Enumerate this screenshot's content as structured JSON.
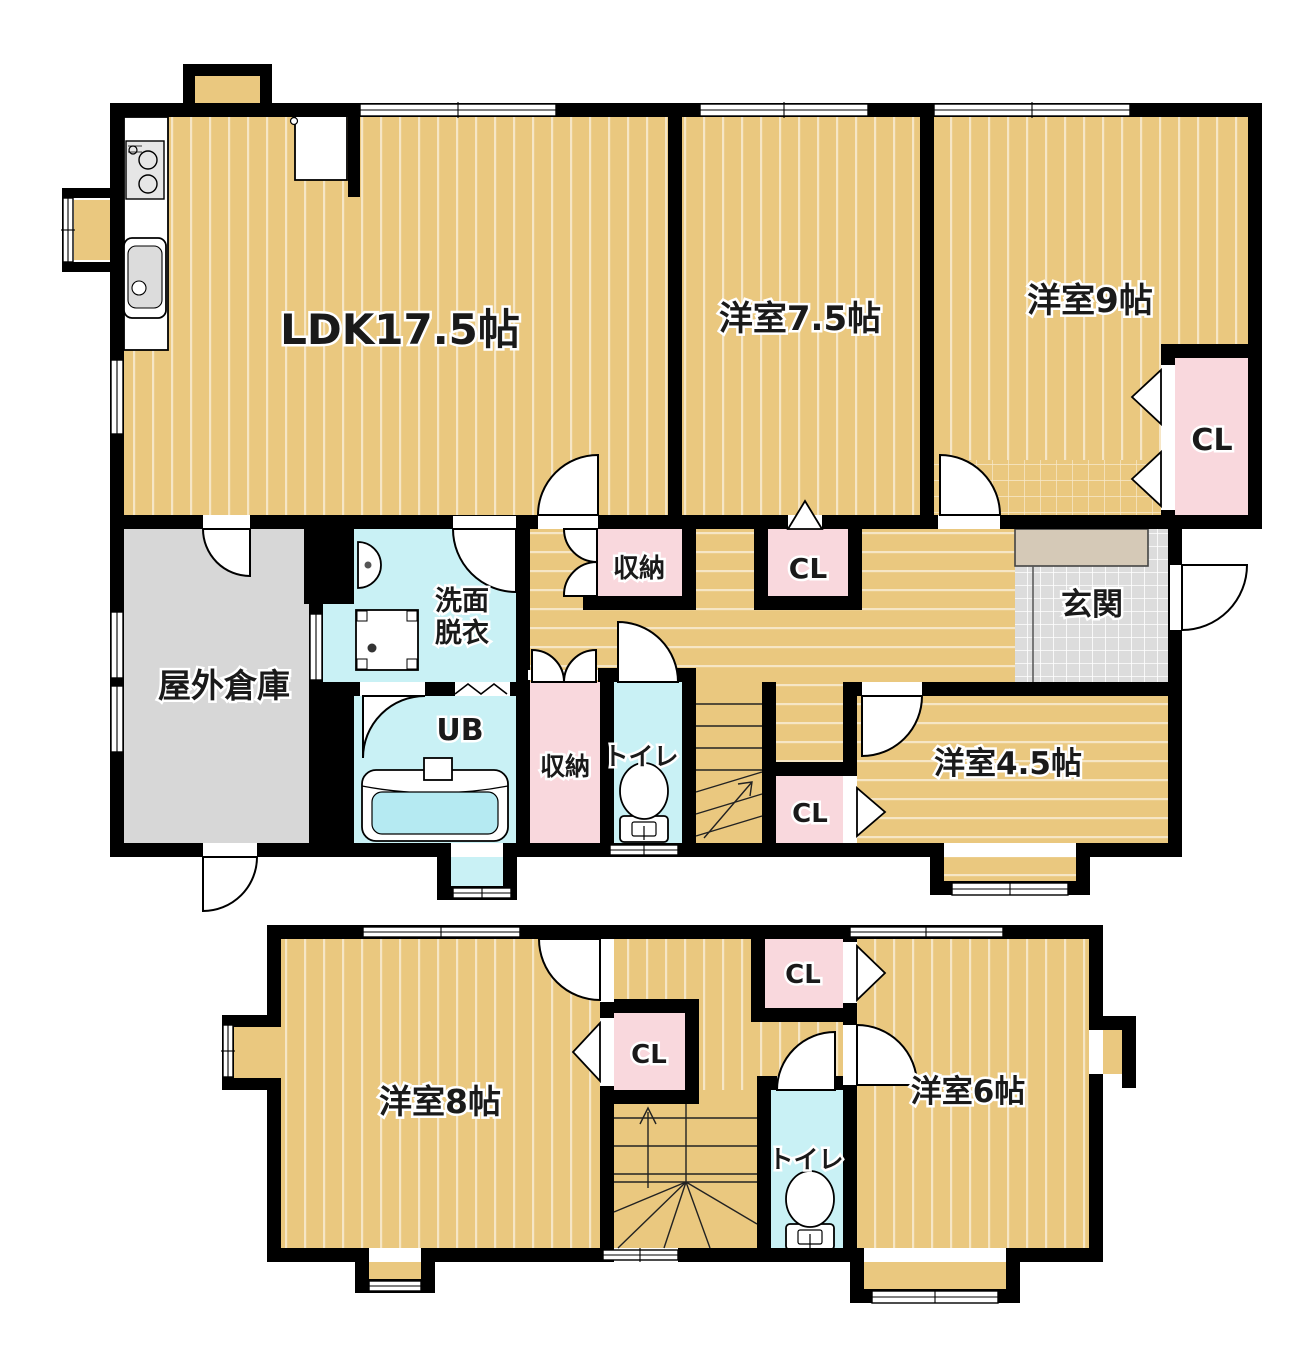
{
  "colors": {
    "floor_tan": "#eac87f",
    "stripe_white": "#ffffff",
    "closet_pink": "#f9d8dd",
    "wet_area_cyan": "#c9f1f5",
    "bathtub_cyan": "#b5eaf2",
    "outdoor_storage_gray": "#d7d7d7",
    "entrance_tile_gray": "#dcdcdc",
    "entrance_step_beige": "#d5c9b7",
    "wall_black": "#000000"
  },
  "floor1": {
    "ldk": "LDK17.5帖",
    "room75": "洋室7.5帖",
    "room9": "洋室9帖",
    "cl9": "CL",
    "hall_storage": "収納",
    "hall_cl": "CL",
    "washroom_line1": "洗面",
    "washroom_line2": "脱衣",
    "outdoor_storage": "屋外倉庫",
    "unit_bath": "UB",
    "storage2": "収納",
    "toilet": "トイレ",
    "cl_mid": "CL",
    "room45": "洋室4.5帖",
    "entrance": "玄関"
  },
  "floor2": {
    "room8": "洋室8帖",
    "cl_top": "CL",
    "cl_left": "CL",
    "toilet": "トイレ",
    "room6": "洋室6帖"
  }
}
